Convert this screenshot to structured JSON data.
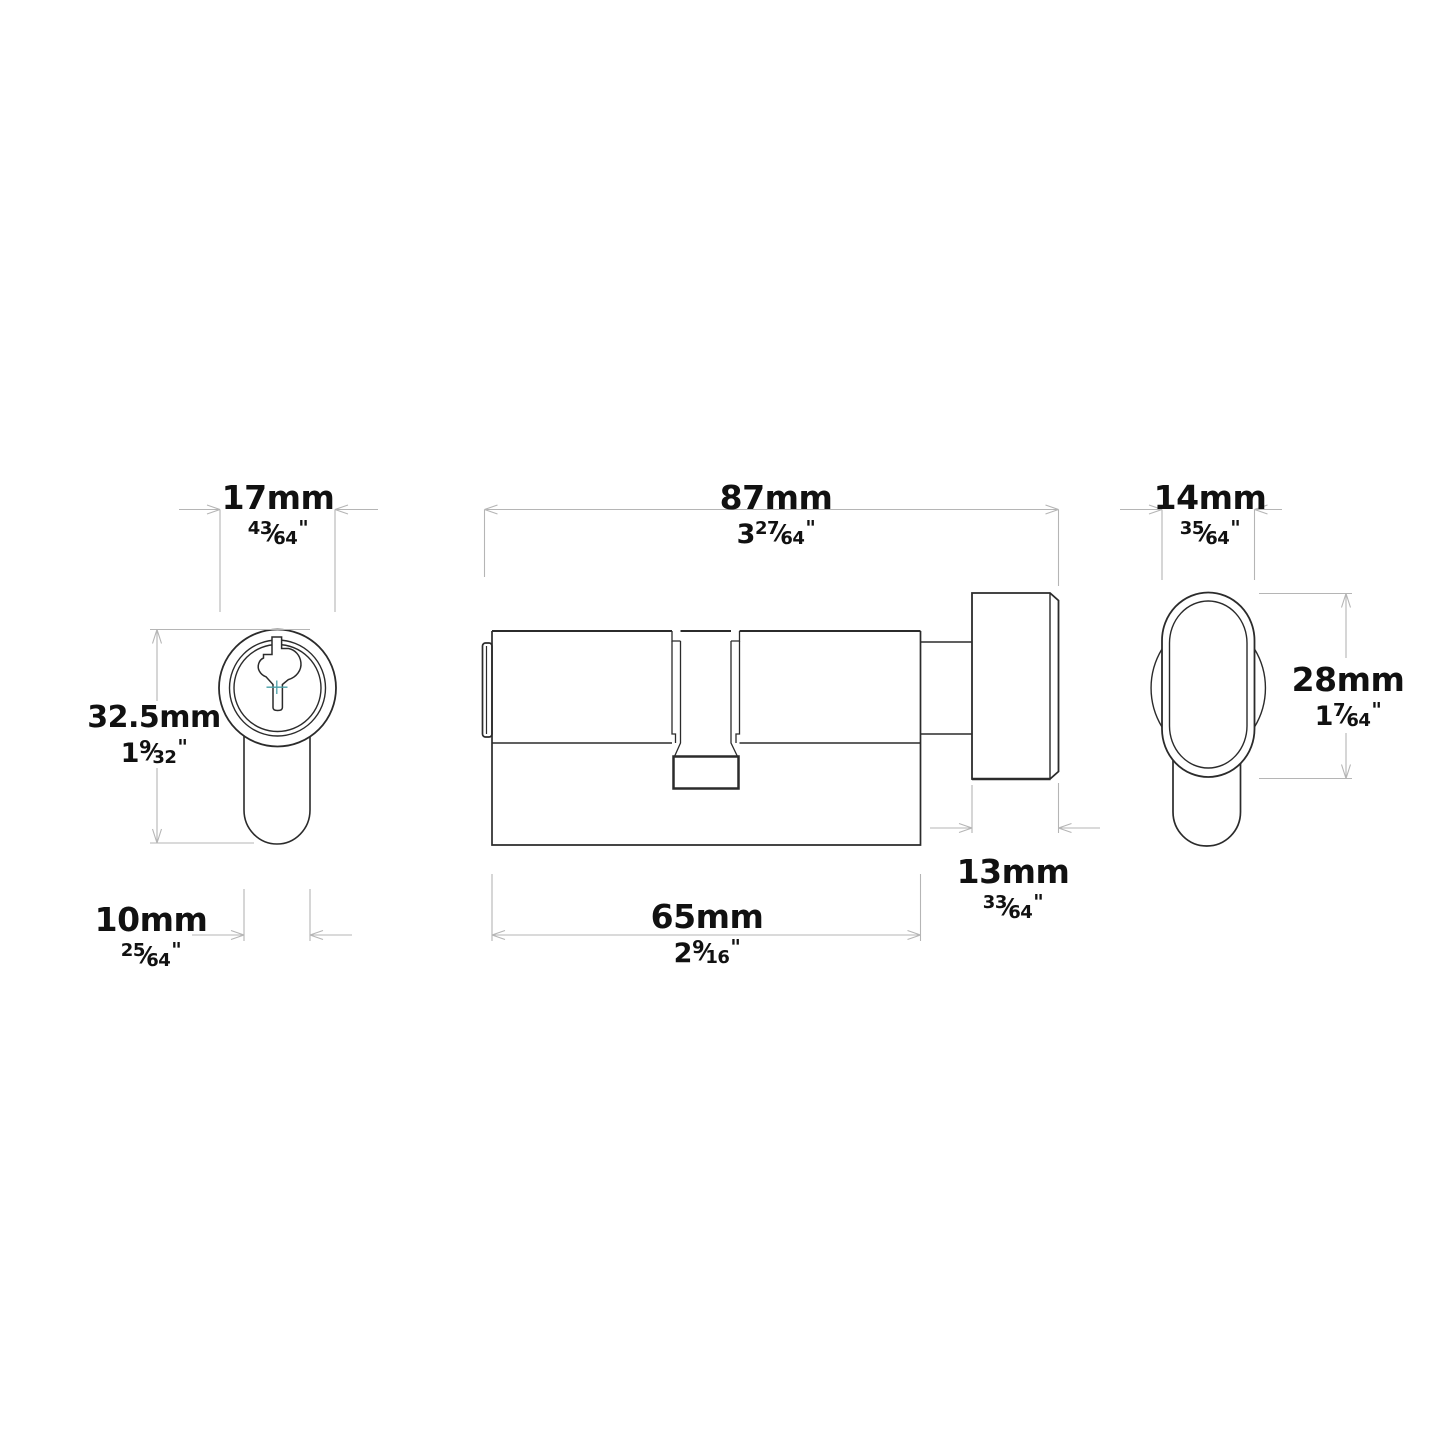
{
  "views": [
    "front-view",
    "side-view",
    "end-view"
  ],
  "dimensions": {
    "w17": {
      "label_mm": "17mm",
      "inch_whole": "",
      "inch_num": "43",
      "inch_den": "64",
      "inch_mark": "\""
    },
    "l87": {
      "label_mm": "87mm",
      "inch_whole": "3",
      "inch_num": "27",
      "inch_den": "64",
      "inch_mark": "\""
    },
    "w14": {
      "label_mm": "14mm",
      "inch_whole": "",
      "inch_num": "35",
      "inch_den": "64",
      "inch_mark": "\""
    },
    "h32_5": {
      "label_mm": "32.5mm",
      "inch_whole": "1",
      "inch_num": "9",
      "inch_den": "32",
      "inch_mark": "\""
    },
    "h28": {
      "label_mm": "28mm",
      "inch_whole": "1",
      "inch_num": "7",
      "inch_den": "64",
      "inch_mark": "\""
    },
    "w10": {
      "label_mm": "10mm",
      "inch_whole": "",
      "inch_num": "25",
      "inch_den": "64",
      "inch_mark": "\""
    },
    "l65": {
      "label_mm": "65mm",
      "inch_whole": "2",
      "inch_num": "9",
      "inch_den": "16",
      "inch_mark": "\""
    },
    "w13": {
      "label_mm": "13mm",
      "inch_whole": "",
      "inch_num": "33",
      "inch_den": "64",
      "inch_mark": "\""
    }
  },
  "fraction_slash": "⁄",
  "colors": {
    "background": "#ffffff",
    "part_line": "#2b2b2b",
    "dimension_line": "#b5b5b5",
    "text": "#111111",
    "accent_teal": "#4aa0a8"
  }
}
